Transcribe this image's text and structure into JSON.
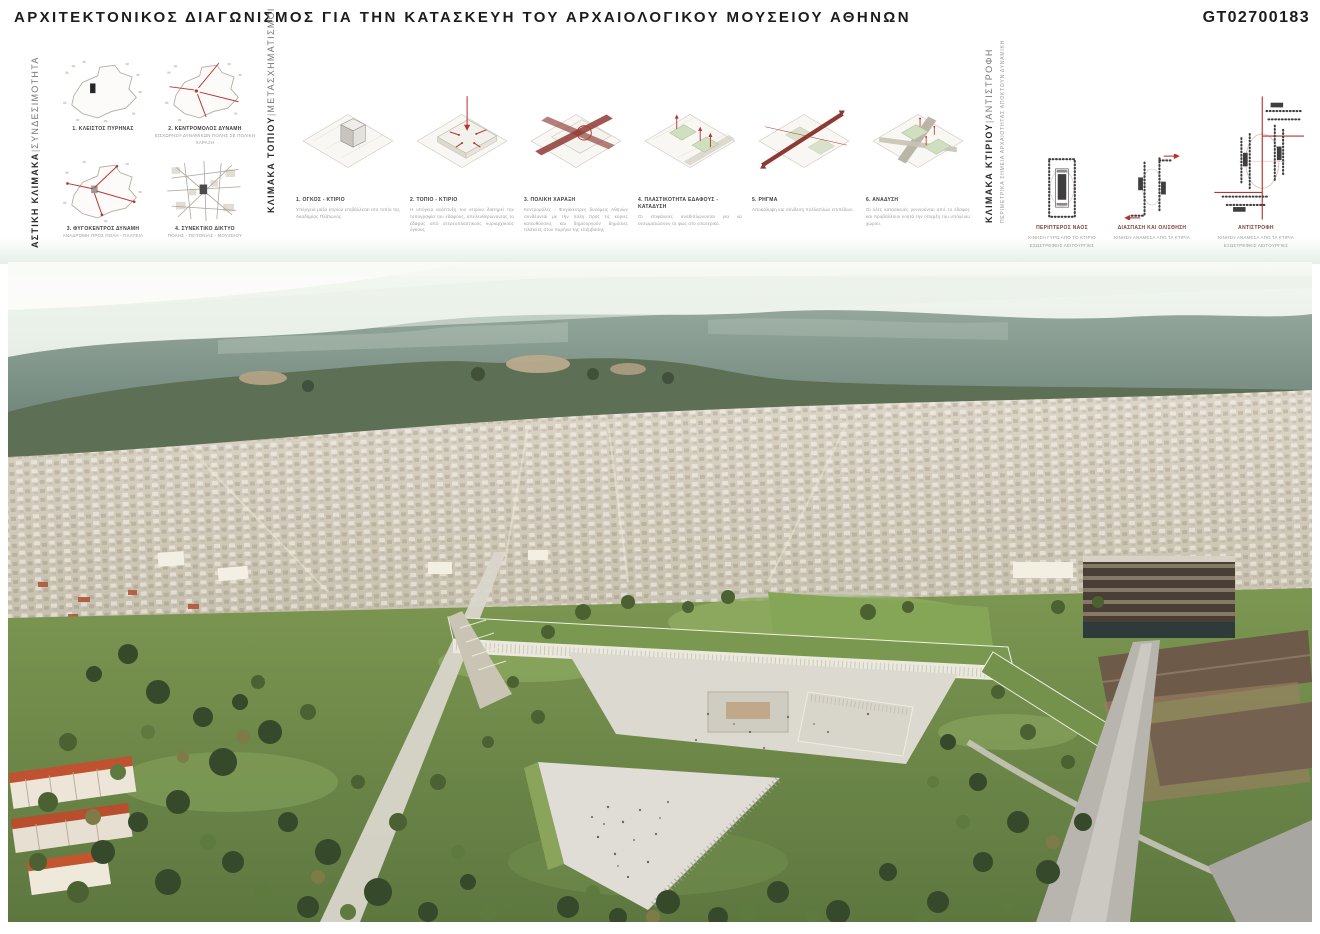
{
  "sep": "|",
  "header": {
    "title": "ΑΡΧΙΤΕΚΤΟΝΙΚΟΣ ΔΙΑΓΩΝΙΣΜΟΣ ΓΙΑ ΤΗΝ ΚΑΤΑΣΚΕΥΗ ΤΟΥ ΑΡΧΑΙΟΛΟΓΙΚΟΥ ΜΟΥΣΕΙΟΥ ΑΘΗΝΩΝ",
    "code": "GT02700183"
  },
  "sections": {
    "urban": {
      "label_bold": "ΑΣΤΙΚΗ ΚΛΙΜΑΚΑ",
      "label_light": "ΣΥΝΔΕΣΙΜΟΤΗΤΑ",
      "diagrams": [
        {
          "title": "1. ΚΛΕΙΣΤΟΣ ΠΥΡΗΝΑΣ",
          "subtitle": ""
        },
        {
          "title": "2. ΚΕΝΤΡΟΜΟΛΟΣ ΔΥΝΑΜΗ",
          "subtitle": "ΕΙΣΧΩΡΗΣΗ ΔΥΝΑΜΙΚΩΝ ΠΟΛΗΣ ΣΕ ΠΟΛΙΚΗ ΧΑΡΑΞΗ"
        },
        {
          "title": "3. ΦΥΓΟΚΕΝΤΡΟΣ ΔΥΝΑΜΗ",
          "subtitle": "ΑΝΑΔΡΟΜΗ ΠΡΟΣ ΠΟΛΗ - ΠΛΑΤΕΙΑ"
        },
        {
          "title": "4. ΣΥΝΕΚΤΙΚΟ ΔΙΚΤΥΟ",
          "subtitle": "ΠΟΛΗΣ - ΓΕΙΤΟΝΙΑΣ - ΜΟΥΣΕΙΟΥ"
        }
      ]
    },
    "landscape": {
      "label_bold": "ΚΛΙΜΑΚΑ ΤΟΠΙΟΥ",
      "label_light": "ΜΕΤΑΣΧΗΜΑΤΙΣΜΟΙ",
      "diagrams": [
        {
          "title": "1. ΟΓΚΟΣ - ΚΤΙΡΙΟ",
          "text": "Υπέργεια μάζα κτιρίου επιβάλλεται στο τοπίο της Ακαδημίας Πλάτωνος."
        },
        {
          "title": "2. ΤΟΠΙΟ - ΚΤΙΡΙΟ",
          "text": "Η υπόγεια ανάπτυξη του κτιρίου διατηρεί την τοπογραφία του εδάφους, απελευθερώνοντας το έδαφος από στερεοπλαστικούς κυριαρχικούς όγκους."
        },
        {
          "title": "3. ΠΟΛΙΚΗ ΧΑΡΑΞΗ",
          "text": "Κεντρομόλες - Φυγόκεντρες δυνάμεις Αθηνών συνδέονται με την πόλη προς τις κύριες κατευθύνσεις και δημιουργούν δημόσιες πλατείες στον πυρήνα της επέμβασης."
        },
        {
          "title": "4. ΠΛΑΣΤΙΚΟΤΗΤΑ ΕΔΑΦΟΥΣ - ΚΑΤΑΔΥΣΗ",
          "text": "Οι επιφάνειες αναδιπλώνονται για να ενσωματώσουν το φως στο εσωτερικό."
        },
        {
          "title": "5. ΡΗΓΜΑ",
          "text": "Αποκάλυψη και σύνδεση πολλαπλών επιπέδων."
        },
        {
          "title": "6. ΑΝΑΔΥΣΗ",
          "text": "Οι νέες κατασκευές γεννιούνται από το έδαφος και προβάλλουν νοητά την ύπαρξη του υπόγειου χώρου."
        }
      ]
    },
    "building": {
      "label_bold": "ΚΛΙΜΑΚΑ ΚΤΙΡΙΟΥ",
      "label_light": "ΑΝΤΙΣΤΡΟΦΗ",
      "label_sub": "ΠΕΡΙΜΕΤΡΙΚΑ ΣΗΜΕΙΑ ΑΡΧΑΙΟΤΗΤΑΣ ΑΠΟΚΤΟΥΝ ΔΥΝΑΜΙΚΗ",
      "diagrams": [
        {
          "title": "ΠΕΡΙΠΤΕΡΟΣ ΝΑΟΣ",
          "line1": "ΚΙΝΗΣΗ ΓΥΡΩ ΑΠΟ ΤΟ ΚΤΙΡΙΟ",
          "line2": "ΕΣΩΣΤΡΕΦΕΙΣ ΛΕΙΤΟΥΡΓΙΕΣ"
        },
        {
          "title": "ΔΙΑΣΠΑΣΗ ΚΑΙ ΟΛΙΣΘΗΣΗ",
          "line1": "ΚΙΝΗΣΗ ΑΝΑΜΕΣΑ ΑΠΟ ΤΑ ΚΤΙΡΙΑ",
          "line2": ""
        },
        {
          "title": "ΑΝΤΙΣΤΡΟΦΗ",
          "line1": "ΚΙΝΗΣΗ ΑΝΑΜΕΣΑ ΑΠΟ ΤΑ ΚΤΙΡΙΑ",
          "line2": "ΕΞΩΣΤΡΕΦΕΙΣ ΛΕΙΤΟΥΡΓΙΕΣ"
        }
      ]
    }
  },
  "colors": {
    "accent_red": "#b6352f",
    "maroon_caption": "#7d4038",
    "ink": "#1c1c1c",
    "caption_grey": "#9a9a9a",
    "wash_green": "#e7f0e7"
  }
}
